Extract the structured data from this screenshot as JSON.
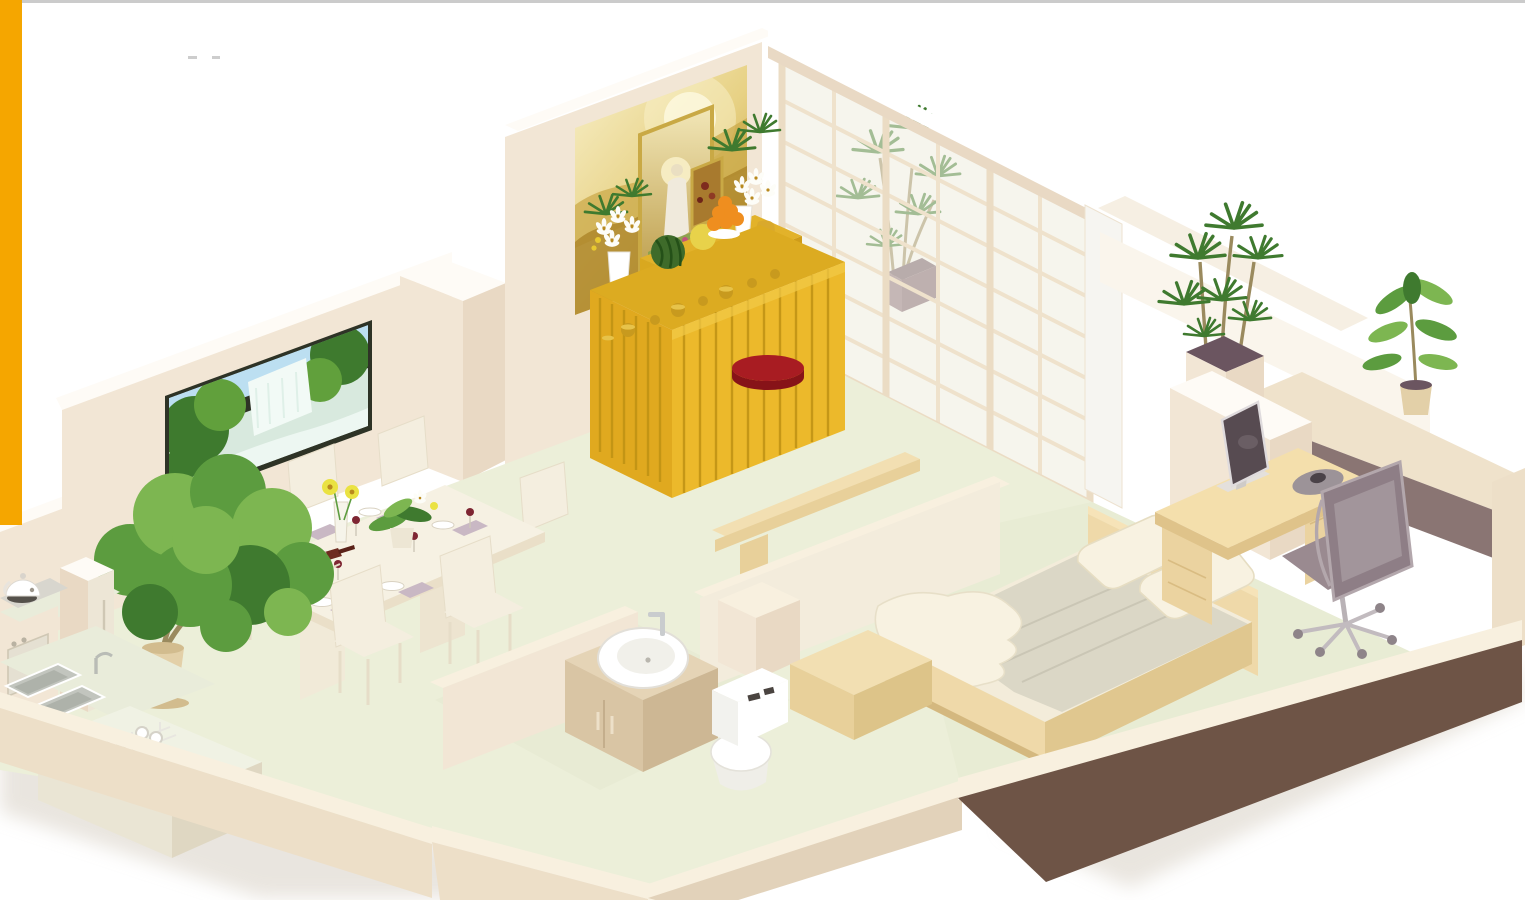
{
  "meta": {
    "title": "3D isometric apartment floor-plan rendering"
  },
  "page": {
    "background": "#FFFFFF",
    "left_accent_bar_color": "#F5A600",
    "top_border_color": "#CBCBCB"
  },
  "palette": {
    "bg": "#FFFFFF",
    "orangeBar": "#F5A600",
    "topLine": "#CBCBCB",
    "shadow": "#D8D0C5",
    "wallFace": "#F2E6D5",
    "wallFaceDark": "#E9D9C4",
    "wallTop": "#FEFBF6",
    "rimCream": "#F8F0DF",
    "outerFace": "#EDDFC8",
    "outerFaceDark": "#E2D2BA",
    "brownFace": "#6E5446",
    "floorMain": "#ECEFD9",
    "floorBed": "#E7EBD2",
    "floorBath": "#E8EBD4",
    "glass": "#F6F4EA",
    "muntin": "#EFE2CC",
    "doorFrame": "#EBDCC4",
    "paintGold1": "#F8F0C9",
    "paintGold2": "#C49E35",
    "paintRidge1": "#CBA94A",
    "paintRidge2": "#AE872C",
    "frameGold": "#C9A945",
    "guanLight": "#F2E7B8",
    "guanDark": "#B99843",
    "altarTop": "#DCAB21",
    "altarSkirt": "#ECB92B",
    "altarPleat": "#BF9214",
    "cushionTop": "#A81C22",
    "cushionSide": "#871318",
    "plantDark": "#3F7A2F",
    "plantMid": "#5C9C3F",
    "plantLight": "#7DB651",
    "trunk": "#9A8A5E",
    "potBeige": "#E3D0A8",
    "potSide": "#D2BC8E",
    "soil": "#6B5560",
    "woodTop": "#F2DFB2",
    "woodFront": "#E8D09A",
    "woodSide": "#DDC489",
    "bedSheet": "#F3ECDA",
    "blanket": "#DBD7C6",
    "blanketLine": "#C6C2B0",
    "pillow": "#F8F2E1",
    "bedFrame": "#EFD9A9",
    "bedFrameDark": "#E0C78F",
    "deskTop": "#F4DFAC",
    "deskFront": "#EBD3A0",
    "deskSide": "#DFC38A",
    "chairBack": "#8E7E86",
    "chairSeat": "#9A8A90",
    "chairLight": "#B3A7AC",
    "metal": "#C2BBBF",
    "monScreen": "#574B51",
    "white": "#FFFFFF",
    "offWhite": "#F6F5F1",
    "basin": "#C2C5BE",
    "basinDark": "#AEB2AA",
    "tvFrame": "#2E3326",
    "sky": "#BCDFF1",
    "forestDark": "#3E7A2E",
    "forestMid": "#61A03C",
    "waterWhite": "#F2FAF6",
    "waterPool": "#D8E9DE",
    "wine": "#7E2633",
    "bottle": "#6E2B20",
    "tableCream": "#F6F1E3",
    "tableEdge": "#EADFC8",
    "chairCream": "#F4EEDF",
    "chairCreamDark": "#E6DDC8",
    "napkin": "#C9B8C4",
    "gerbera": "#EAE242",
    "gerberaCenter": "#B98A1E",
    "orangeFruit": "#EF8E1F",
    "melonYellow": "#E8D24A",
    "wmGreen": "#3E6B2A",
    "wmStripe": "#245018",
    "mauveBand": "#8A7573",
    "ledgeTop": "#EFE2CB",
    "grayAppliance": "#D8D6CE",
    "burner": "#55514B",
    "lilyWhite": "#FDFDF8",
    "goldVase": "#D9A92C",
    "purplePot": "#8A6E78"
  },
  "scene": {
    "type": "isometric-apartment-render",
    "rooms": [
      {
        "name": "kitchen",
        "items": [
          "kettle",
          "cooktop",
          "oven-cabinet",
          "tall-cabinet",
          "double-sink",
          "island-counter",
          "dish-rack-with-cups"
        ]
      },
      {
        "name": "dining-area",
        "items": [
          "dining-table",
          "six-cream-chairs",
          "place-settings",
          "wine-bottle",
          "wine-glasses",
          "gerbera-vase",
          "orchid-centerpiece",
          "waterfall-wall-picture",
          "potted-ficus-tree"
        ]
      },
      {
        "name": "worship-room",
        "items": [
          "golden-landscape-painting",
          "guanyin-framed-picture",
          "small-framed-picture",
          "altar-table-with-yellow-pleated-skirt",
          "watermelon",
          "pomelo",
          "orange-pyramid",
          "lily-vases",
          "green-plant-sprays",
          "incense-cups",
          "red-prayer-cushion",
          "wooden-bench",
          "low-partition-wall"
        ]
      },
      {
        "name": "balcony",
        "items": [
          "sliding-shoji-glass-doors",
          "potted-palm-behind-glass"
        ]
      },
      {
        "name": "bathroom",
        "items": [
          "vanity-cabinet",
          "round-vessel-basin",
          "chrome-faucet",
          "toilet"
        ]
      },
      {
        "name": "bedroom",
        "items": [
          "double-bed",
          "two-pillows",
          "gray-blanket",
          "crumpled-sheet",
          "headboard-panel",
          "foot-bench",
          "wooden-desk",
          "monitor",
          "mouse-pad-with-mouse",
          "office-chair",
          "knob-dresser",
          "square-planter-dracaena",
          "window-ledge-plant",
          "dark-brown-outer-wall"
        ]
      }
    ]
  },
  "artifacts": {
    "faint_specks": "two tiny light-gray marks near top-left"
  }
}
